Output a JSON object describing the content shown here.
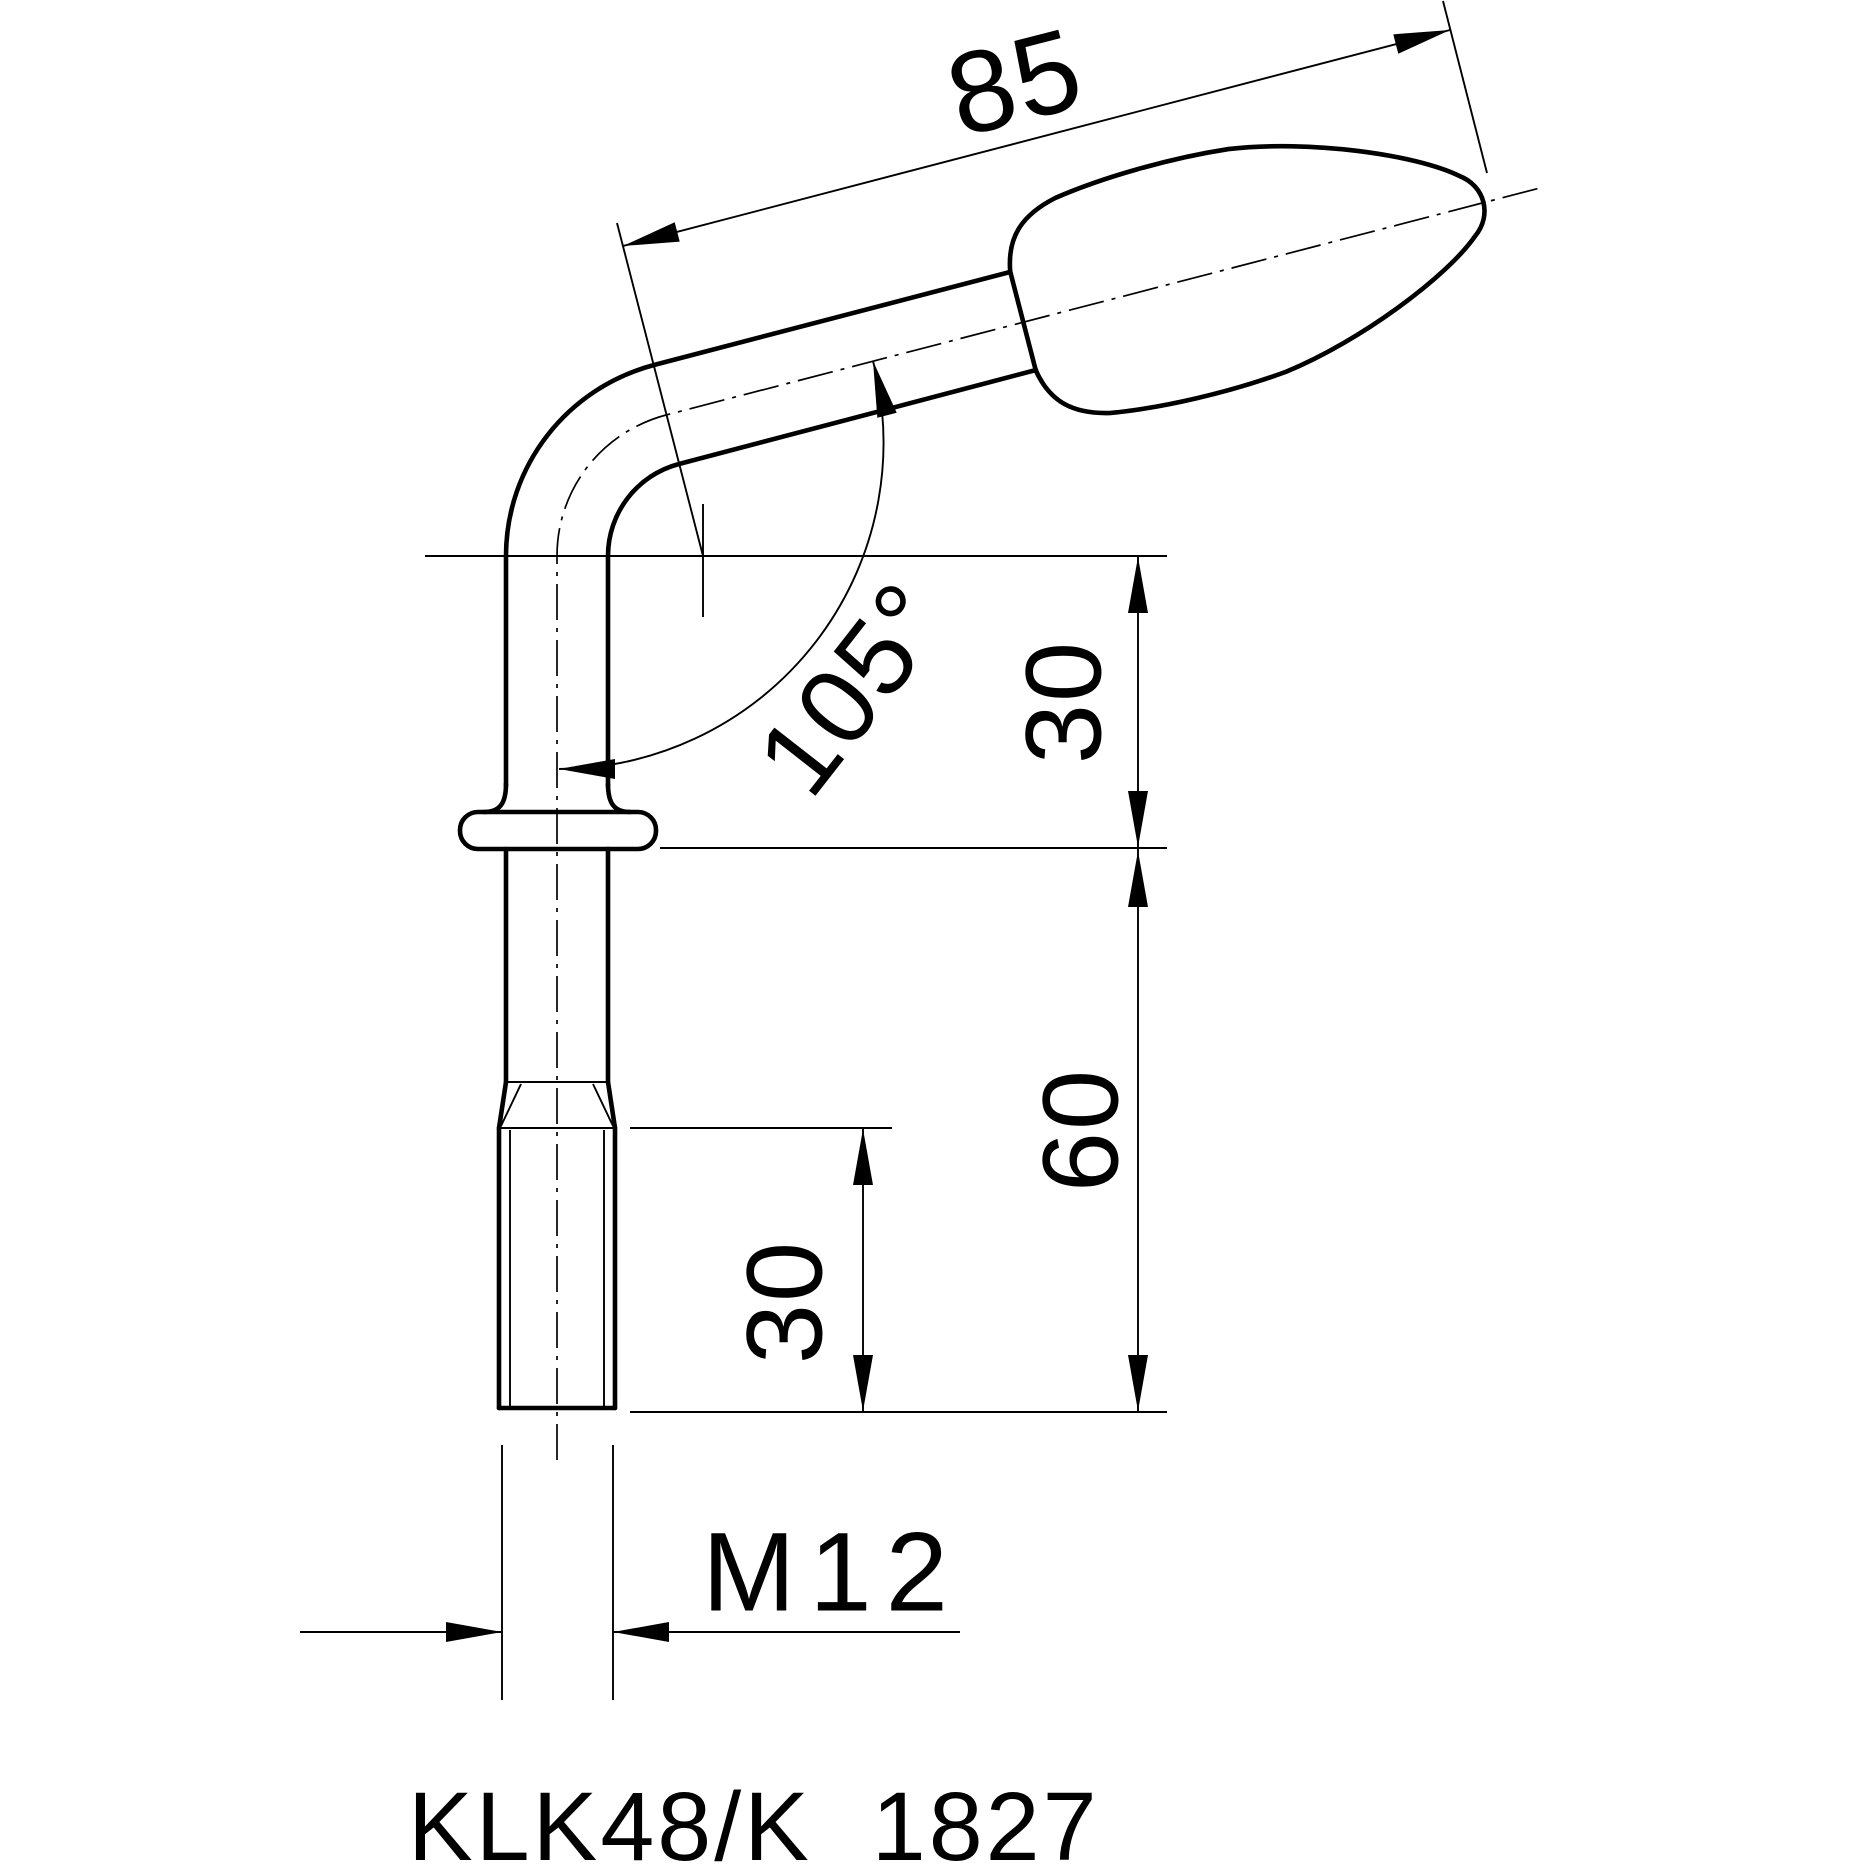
{
  "drawing": {
    "part_label": "KLK48/K  1827",
    "dims": {
      "handle_length": "85",
      "bend_angle": "105°",
      "bend_to_collar": "30",
      "shank_length": "60",
      "thread_length": "30",
      "thread_spec": "M12"
    },
    "colors": {
      "ink": "#000000",
      "paper": "#ffffff"
    }
  }
}
